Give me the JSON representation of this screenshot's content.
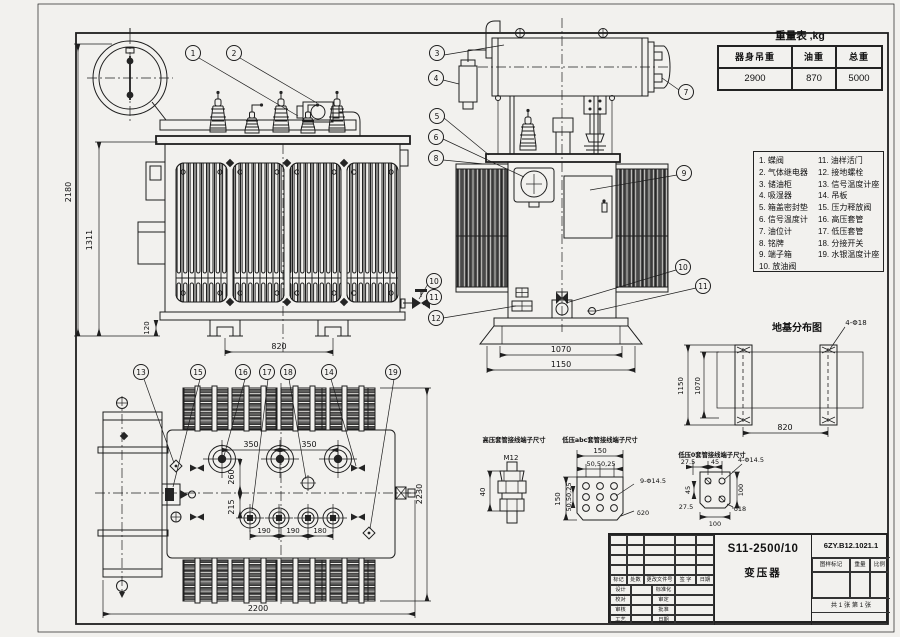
{
  "page": {
    "bg": "#f2f1ee",
    "line_color": "#1e1e1e"
  },
  "callouts": [
    "1",
    "2",
    "3",
    "4",
    "5",
    "6",
    "7",
    "8",
    "9",
    "10",
    "11",
    "12",
    "13",
    "14",
    "15",
    "16",
    "17",
    "18",
    "19"
  ],
  "weight_table": {
    "title": "重量表 ,kg",
    "headers": [
      "器身吊重",
      "油重",
      "总重"
    ],
    "values": [
      "2900",
      "870",
      "5000"
    ]
  },
  "parts_list": {
    "left": [
      "1. 蝶阀",
      "2. 气体继电器",
      "3. 储油柜",
      "4. 吸湿器",
      "5. 箱盖密封垫",
      "6. 信号温度计",
      "7. 油位计",
      "8. 铭牌",
      "9. 端子箱",
      "10. 放油阀"
    ],
    "right": [
      "11. 油样活门",
      "12. 接地螺栓",
      "13. 信号温度计座",
      "14. 吊板",
      "15. 压力释放阀",
      "16. 高压套管",
      "17. 低压套管",
      "18. 分接开关",
      "19. 水银温度计座"
    ]
  },
  "views": {
    "front": {
      "dims": {
        "total_height": "2180",
        "tank_height": "1311",
        "base_height": "120",
        "wheel_span": "820"
      }
    },
    "side": {
      "dims": {
        "base_inner": "1070",
        "base_outer": "1150"
      }
    },
    "plan": {
      "dims": {
        "hv_pitch_a": "350",
        "hv_pitch_b": "350",
        "hv_offset": "260",
        "lv_offset": "215",
        "lv_pitch_a": "190",
        "lv_pitch_b": "190",
        "lv_pitch_c": "180",
        "overall_length": "2200",
        "overall_width": "2230"
      }
    }
  },
  "foundation": {
    "title": "地基分布图",
    "dims": {
      "rail_length": "1150",
      "slab_width": "1070",
      "rail_span": "820",
      "anchor_holes": "4-Φ18"
    }
  },
  "terminals": {
    "hv": {
      "title": "高压套管接线端子尺寸",
      "thread": "M12",
      "height": "40"
    },
    "lv_abc": {
      "title": "低压abc套管接线端子尺寸",
      "width": "150",
      "height": "150",
      "pitch_h": "50,50,25",
      "pitch_v": "50,50,25",
      "holes": "9-Φ14.5",
      "thickness": "δ20"
    },
    "lv_o": {
      "title": "低压0套管接线端子尺寸",
      "top_a": "27.5",
      "top_b": "45",
      "holes": "4-Φ14.5",
      "left_a": "45",
      "left_b": "27.5",
      "width": "100",
      "height": "100",
      "thickness": "δ18"
    }
  },
  "title_block": {
    "model": "S11-2500/10",
    "product": "变压器",
    "drawing_no": "6ZY.B12.1021.1",
    "stamp_label": "图样标记",
    "weight_label": "重量",
    "scale_label": "比例",
    "sheet_info": "共 1 张 第 1 张",
    "rev_headers": [
      "标记",
      "处数",
      "更改文件号",
      "签 字",
      "日期"
    ],
    "roles_left": [
      "设计",
      "校对",
      "审核",
      "工艺"
    ],
    "roles_right": [
      "标准化",
      "审定",
      "批准",
      "日期"
    ]
  }
}
